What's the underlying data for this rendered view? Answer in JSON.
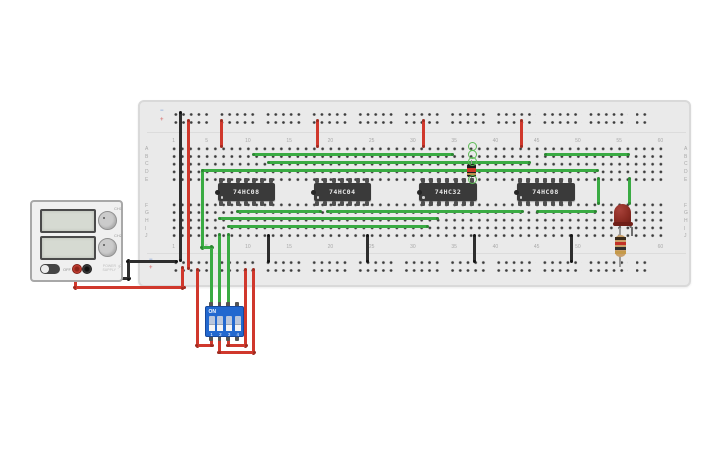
{
  "breadboard": {
    "column_labels": [
      "1",
      "5",
      "10",
      "15",
      "20",
      "25",
      "30",
      "35",
      "40",
      "45",
      "50",
      "55",
      "60"
    ],
    "row_labels_top": [
      "A",
      "B",
      "C",
      "D",
      "E"
    ],
    "row_labels_bottom": [
      "F",
      "G",
      "H",
      "I",
      "J"
    ],
    "rail_negative_symbol": "−",
    "rail_positive_symbol": "+"
  },
  "chips": [
    {
      "label": "74HC08"
    },
    {
      "label": "74HC04"
    },
    {
      "label": "74HC32"
    },
    {
      "label": "74HC08"
    }
  ],
  "dip_switch": {
    "on_label": "ON",
    "positions": [
      "1",
      "2",
      "3",
      "4"
    ]
  },
  "power_supply": {
    "off_label": "OFF",
    "ch1_label": "CH1",
    "ch2_label": "CH2",
    "name_line1": "POWER",
    "name_line2": "SUPPLY",
    "bolt": "⚡"
  },
  "colors": {
    "wire_green": "#3aab43",
    "wire_red": "#d0382c",
    "wire_black": "#2e2e2e",
    "board": "#eaeaea",
    "chip_body": "#3a3a3a",
    "dip_blue": "#2268cf",
    "led_red": "#8a2b22",
    "highlight_ring_green": "#5dbb55"
  }
}
